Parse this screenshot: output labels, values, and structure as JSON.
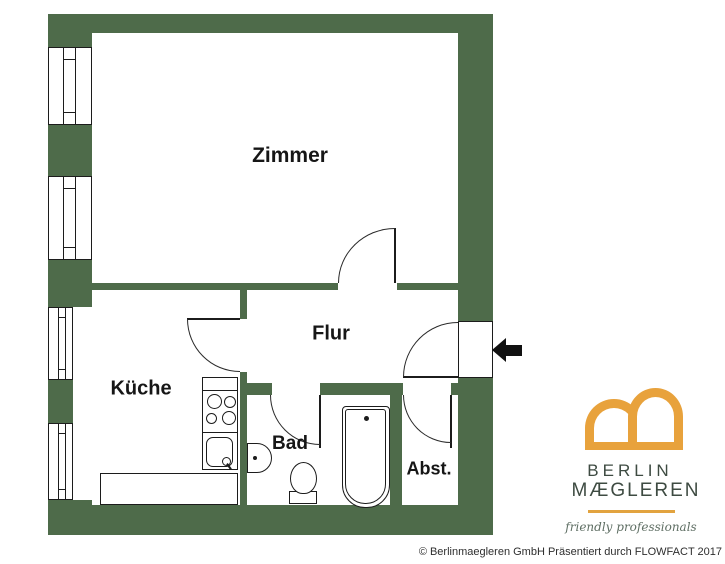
{
  "colors": {
    "wall_green": "#4e6b4a",
    "logo_orange": "#e8a23c",
    "logo_text_green": "#3e4b42",
    "line_black": "#1c1c1c"
  },
  "rooms": {
    "zimmer": "Zimmer",
    "kueche": "Küche",
    "flur": "Flur",
    "bad": "Bad",
    "abst": "Abst."
  },
  "fixtures": [
    "window",
    "window",
    "window",
    "window",
    "door-zimmer",
    "door-kueche",
    "door-bad",
    "door-abst",
    "entrance-door",
    "stove",
    "kitchen-sink",
    "counter",
    "washbasin",
    "toilet",
    "bathtub"
  ],
  "entrance": {
    "arrow_direction": "left"
  },
  "logo": {
    "line1": "BERLIN",
    "line2": "MÆGLEREN",
    "tagline": "friendly professionals"
  },
  "footer": {
    "copyright": "© Berlinmaegleren GmbH Präsentiert durch FLOWFACT 2017"
  }
}
